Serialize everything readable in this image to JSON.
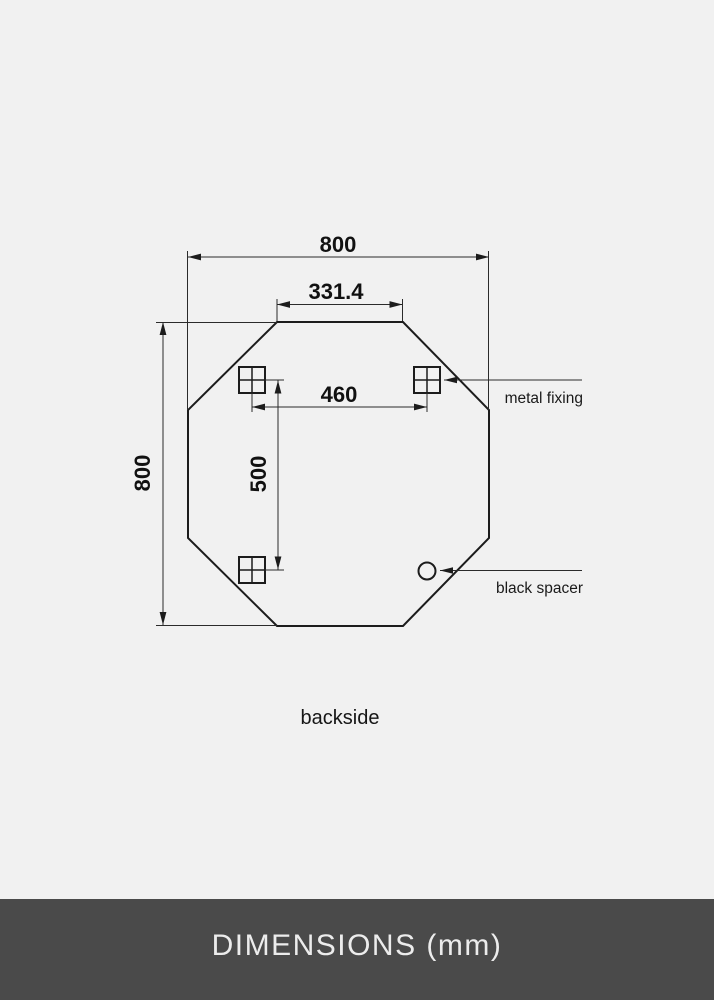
{
  "diagram": {
    "dim_top_width": "800",
    "dim_top_flat": "331.4",
    "dim_left_height": "800",
    "dim_fixing_spacing_h": "460",
    "dim_fixing_spacing_v": "500",
    "label_metal_fixing": "metal fixing",
    "label_black_spacer": "black spacer",
    "caption": "backside",
    "unit": "mm",
    "fixing_count": "3",
    "spacer_count": "1"
  },
  "footer": {
    "title": "DIMENSIONS (mm)"
  },
  "colors": {
    "background": "#f1f1f1",
    "line": "#1c1c1c",
    "dimension_line": "#2b2b2b",
    "footer_background": "#4a4a4a",
    "footer_text": "#ececec"
  }
}
